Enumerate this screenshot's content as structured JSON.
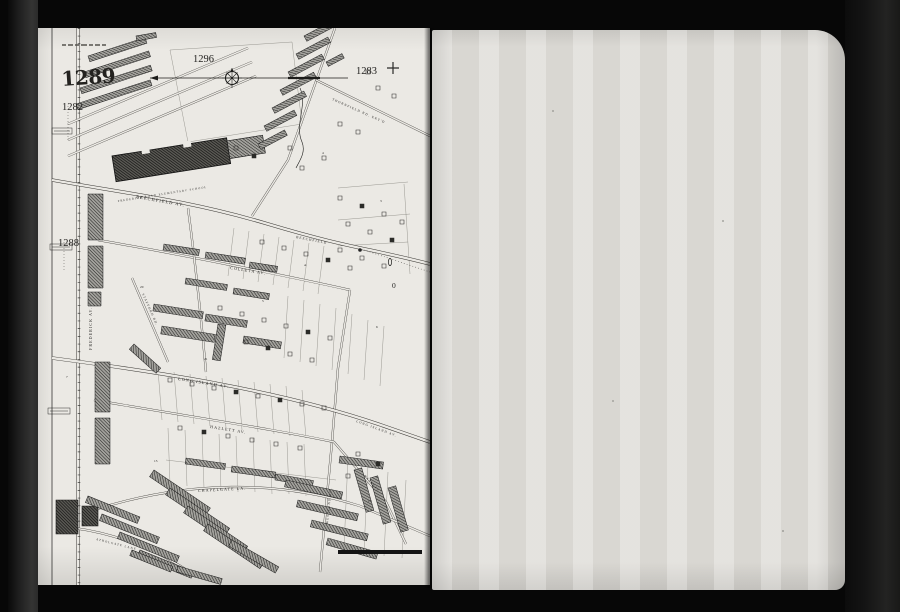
{
  "map": {
    "plate_numbers": {
      "main": "1289",
      "top": "1296",
      "top_right": "1283",
      "left_upper": "1282",
      "left_lower": "1288"
    },
    "streets": {
      "frederick": "FREDERICK AV.",
      "beechfield": "BEECHFIELD AV.",
      "beechfield2": "BEECHFIELD",
      "colleta": "COLLETA AV.",
      "long_island": "LONG ISLAND AV.",
      "long_island2": "LONG ISLAND AV.",
      "hazlett": "HAZLETT AV.",
      "hazlett2": "HAZLETT",
      "westland": "WESTLAND RD.",
      "stafford": "STAFFORD RD.",
      "chapelgate": "CHAPELGATE LA.",
      "atholgate": "ATHOLGATE LANE",
      "thornfield": "THORNFIELD RD. EXT'D"
    },
    "labels": {
      "school": "FREDERICK ROAD ELEMENTARY SCHOOL",
      "zero_marker": "0"
    },
    "lot_numbers": [
      "20",
      "21",
      "15",
      "13",
      "6",
      "5",
      "4",
      "A",
      "3",
      "7"
    ],
    "icons": {
      "compass": "compass-rose-icon",
      "registration_cross": "plus-mark-icon"
    },
    "colors": {
      "paper_left": "#ebe9e4",
      "paper_right": "#dedcd7",
      "background": "#070707",
      "ink": "#22211f"
    }
  }
}
